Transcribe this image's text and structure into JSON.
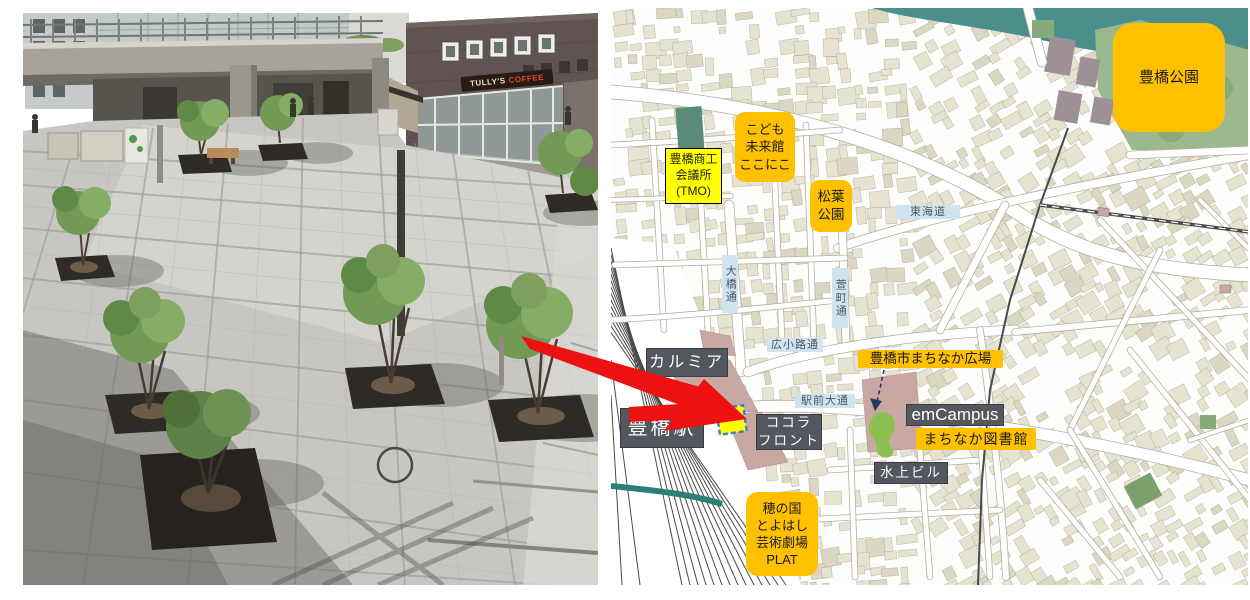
{
  "figure": {
    "photo": {
      "description": "aerial view of paved station-front plaza with trees",
      "tullys_sign": {
        "word1": "TULLY'S",
        "word2": "COFFEE"
      }
    },
    "map": {
      "labels": {
        "toyohashi_park": "豊橋公園",
        "chamber_of_commerce": "豊橋商工\n会議所\n(TMO)",
        "kodomo_mirai_kan": "こども\n未来館\nここにこ",
        "matsuba_park": "松葉\n公園",
        "tokaido": "東海道",
        "ohashi_dori": "大橋通",
        "kayamachi_dori": "萱町通",
        "hirokoji_dori": "広小路通",
        "ekimae_odori": "駅前大通",
        "calmia": "カルミア",
        "toyohashi_station": "豊橋駅",
        "cocola_front": "ココラ\nフロント",
        "machinaka_hiroba": "豊橋市まちなか広場",
        "emcampus": "emCampus",
        "machinaka_library": "まちなか図書館",
        "suijo_building": "水上ビル",
        "plat_theatre": "穂の国\nとよはし\n芸術劇場\nPLAT"
      },
      "colors": {
        "label_orange": "#FFC000",
        "label_dark": "#54575E",
        "road_label_blue": "#CFE4F0",
        "highlight_yellow": "#FFFF00",
        "highlight_border_blue": "#3B7DC8",
        "red_arrow": "#ED1111",
        "park_green": "#9CB88E",
        "river_teal": "#4B8F8D",
        "plaza_green_blob": "#8CC152",
        "building_beige": "#E7E3D1",
        "station_pink": "#C9A8A3"
      }
    }
  }
}
